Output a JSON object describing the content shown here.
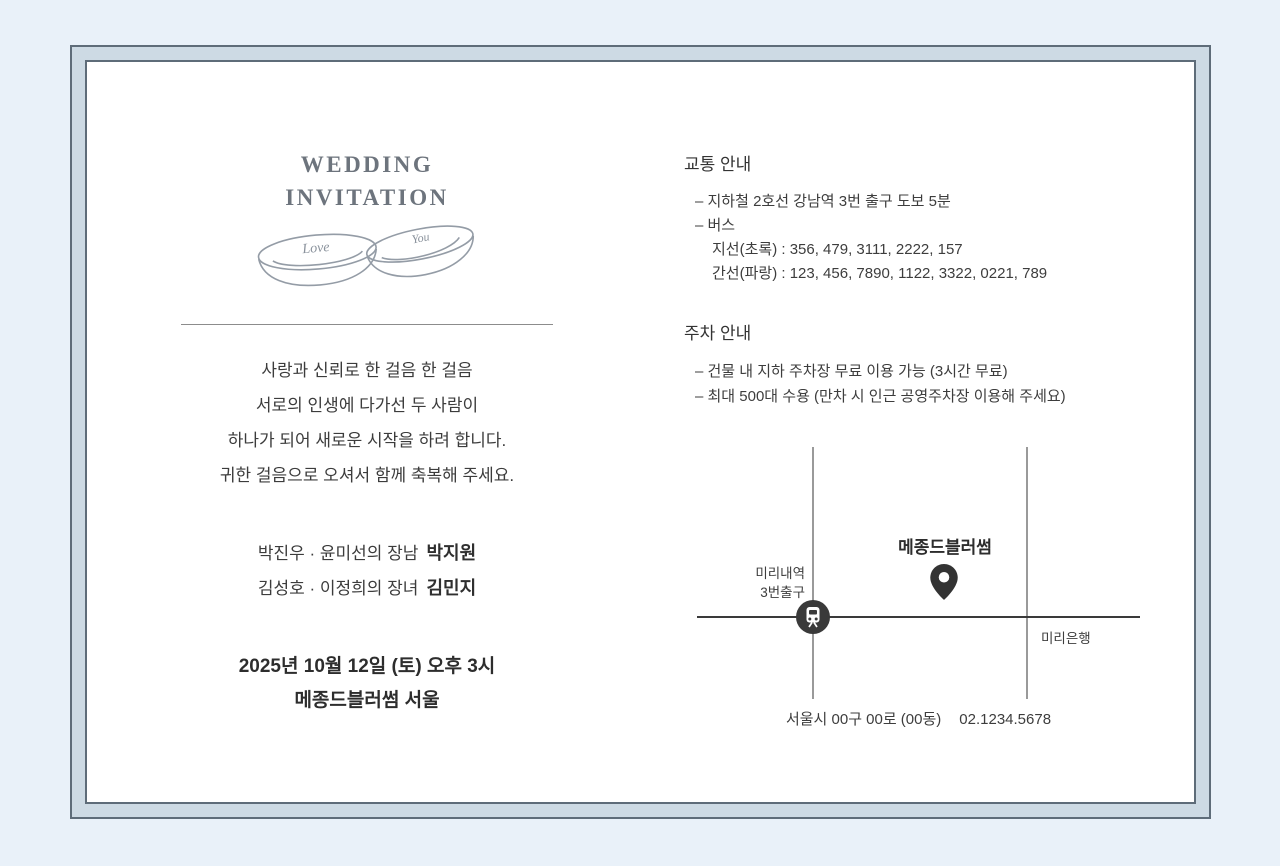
{
  "card": {
    "colors": {
      "background": "#e9f1f9",
      "frame_border": "#5e6c79",
      "frame_band": "#cddae4",
      "title_text": "#6d747d",
      "body_text": "#3c3c3c",
      "road_gray": "#9a9a9a",
      "road_dark": "#3a3a3a",
      "icon_dark": "#333333"
    },
    "title": {
      "line1": "WEDDING",
      "line2": "INVITATION"
    },
    "rings": {
      "engraving1": "Love",
      "engraving2": "You"
    },
    "left": {
      "message_lines": [
        "사랑과 신뢰로 한 걸음 한 걸음",
        "서로의 인생에 다가선 두 사람이",
        "하나가 되어 새로운 시작을 하려 합니다.",
        "귀한 걸음으로 오셔서 함께 축복해 주세요."
      ],
      "parents": [
        {
          "label": "박진우 · 윤미선의 장남",
          "name": "박지원"
        },
        {
          "label": "김성호 · 이정희의 장녀",
          "name": "김민지"
        }
      ],
      "datetime": "2025년 10월 12일 (토) 오후 3시",
      "venue": "메종드블러썸 서울"
    },
    "right": {
      "traffic": {
        "heading": "교통 안내",
        "item1": "– 지하철 2호선 강남역 3번 출구 도보 5분",
        "item2": "– 버스",
        "bus_line1": "지선(초록) : 356, 479, 3111, 2222, 157",
        "bus_line2": "간선(파랑) : 123, 456, 7890, 1122, 3322, 0221, 789"
      },
      "parking": {
        "heading": "주차 안내",
        "item1": "– 건물 내 지하 주차장 무료 이용 가능 (3시간 무료)",
        "item2": "– 최대 500대 수용 (만차 시 인근 공영주차장 이용해 주세요)"
      },
      "map": {
        "venue_label": "메종드블러썸",
        "station_line1": "미리내역",
        "station_line2": "3번출구",
        "bank_label": "미리은행",
        "address": "서울시 00구 00로 (00동)",
        "phone": "02.1234.5678"
      }
    }
  }
}
